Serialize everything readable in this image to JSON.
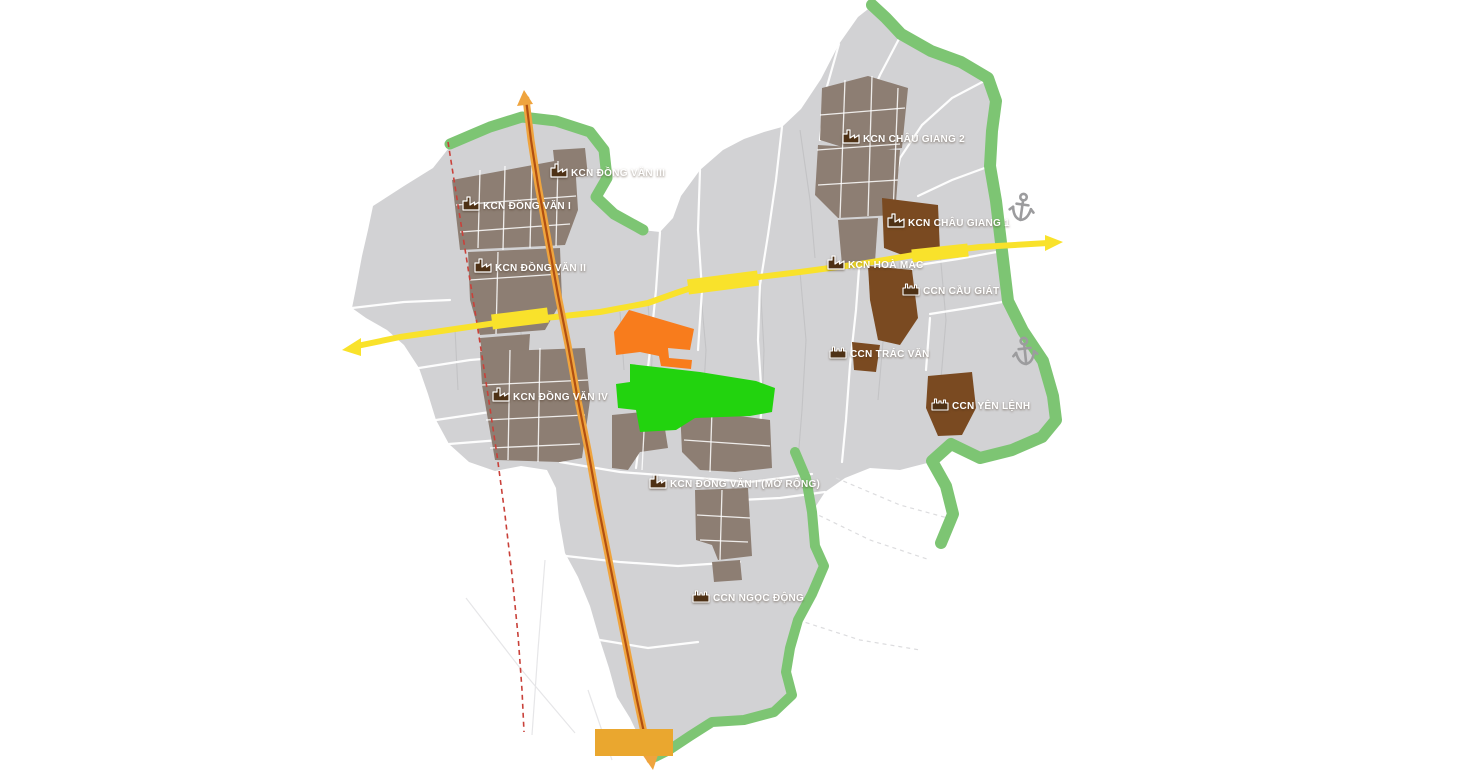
{
  "map": {
    "labels": [
      {
        "id": "kcn-dong-van-3",
        "type": "industrial-park",
        "text": "KCN ĐỒNG VĂN III"
      },
      {
        "id": "kcn-dong-van-1",
        "type": "industrial-park",
        "text": "KCN ĐỒNG VĂN I"
      },
      {
        "id": "kcn-dong-van-2",
        "type": "industrial-park",
        "text": "KCN ĐỒNG VĂN II"
      },
      {
        "id": "kcn-dong-van-4",
        "type": "industrial-park",
        "text": "KCN ĐỒNG VĂN IV"
      },
      {
        "id": "kcn-dong-van-1-mo-rong",
        "type": "industrial-park",
        "text": "KCN ĐỒNG VĂN I (MỞ RỘNG)"
      },
      {
        "id": "ccn-ngoc-dong",
        "type": "industrial-cluster",
        "text": "CCN NGỌC ĐỘNG"
      },
      {
        "id": "kcn-chau-giang-2",
        "type": "industrial-park",
        "text": "KCN CHÂU GIANG 2"
      },
      {
        "id": "kcn-chau-giang-1",
        "type": "industrial-park",
        "text": "KCN CHÂU GIANG 1"
      },
      {
        "id": "kcn-hoa-mac",
        "type": "industrial-park",
        "text": "KCN HOÀ MẠC"
      },
      {
        "id": "ccn-cau-giat",
        "type": "industrial-cluster",
        "text": "CCN CẦU GIÁT"
      },
      {
        "id": "ccn-trac-van",
        "type": "industrial-cluster",
        "text": "CCN TRÁC VĂN"
      },
      {
        "id": "ccn-yen-lenh",
        "type": "industrial-cluster",
        "text": "CCN YÊN LỆNH"
      }
    ],
    "icons": {
      "industrial_park": "factory-icon",
      "industrial_cluster": "factory-icon",
      "port": "anchor-icon"
    },
    "colors": {
      "background": "#ffffff",
      "territory": "#d2d2d4",
      "commune_boundary": "#ffffff",
      "built_industrial": "#8d7e73",
      "planned_industrial": "#7a4a21",
      "highlight_orange_zone": "#f87c1c",
      "highlight_green_zone": "#22d30e",
      "green_corridor": "#7dc573",
      "expressway_yellow": "#f9e22b",
      "national_road_orange": "#efa43e",
      "national_road_core": "#b04f12",
      "railway_red": "#c9413a",
      "bridge_marker": "#eaa72f",
      "anchor_gray": "#9c9c9e",
      "label_text": "#ffffff",
      "label_icon": "#4e3115"
    }
  }
}
